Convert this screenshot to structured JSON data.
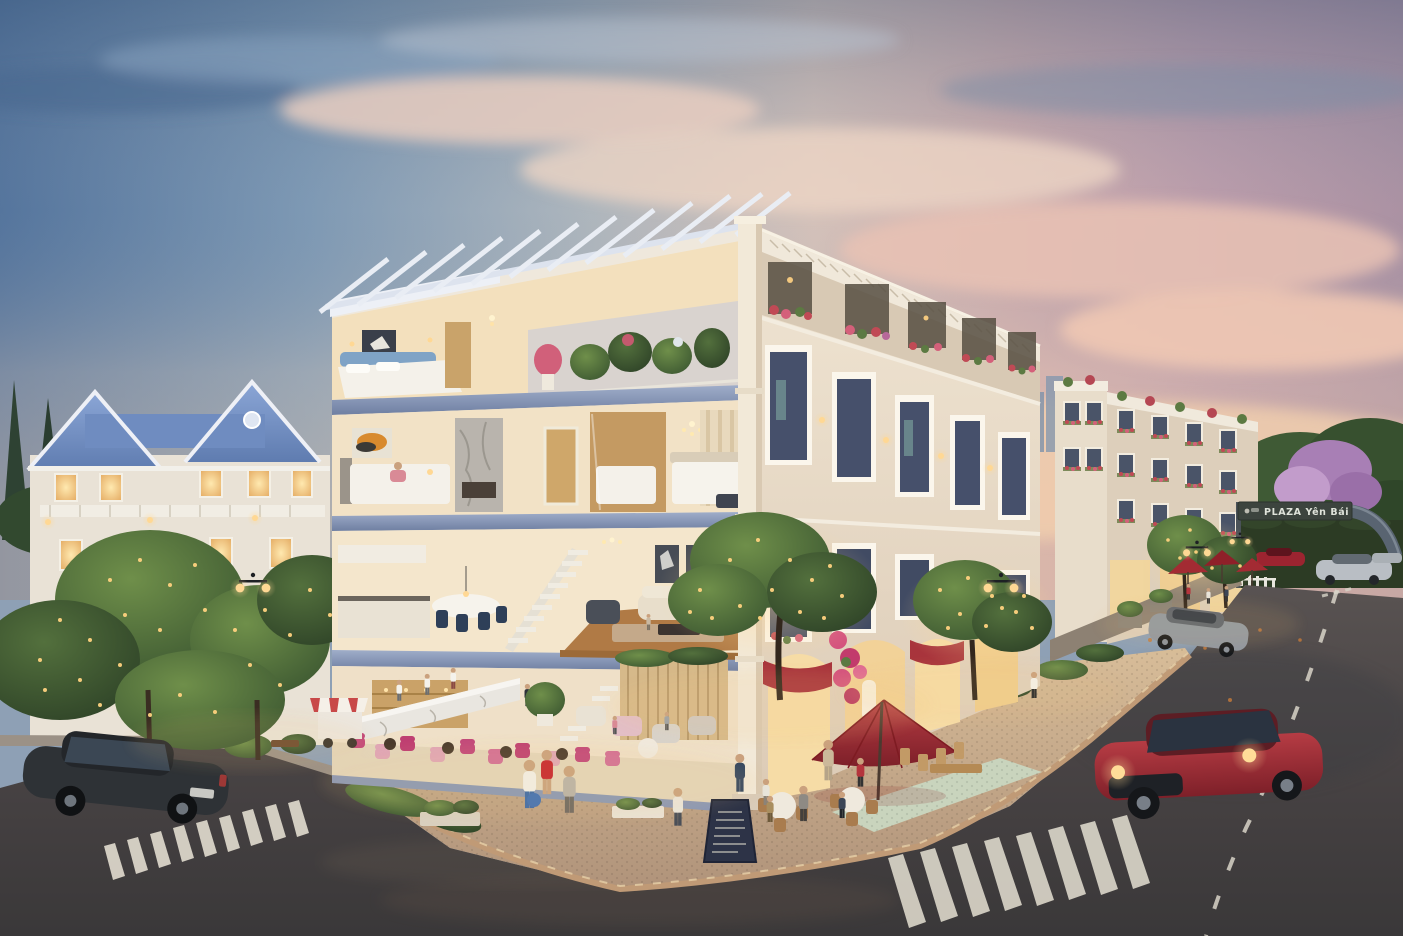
{
  "scene": {
    "title": "Dusk architectural rendering of a neoclassical shophouse corner block with cutaway interiors",
    "time_of_day": "dusk",
    "weather": "clear",
    "description": "Four-storey white shophouse at a street corner shown in section: rooftop pergola terrace, bedrooms, living/kitchen floor and ground-floor cafe; ornate facade with flower balconies, red awnings and string-lit trees; streets with zebra crossings, cars, pedestrians, red patio umbrellas and an entrance gateway arch."
  },
  "signage": {
    "gateway_sign": "PLAZA Yên Bái"
  },
  "objects": {
    "vehicles": [
      "dark sedan bottom-left",
      "red coupe with headlights on",
      "parked silver sedan",
      "silver sedan at gateway",
      "red sports car at gateway",
      "blue car at gateway"
    ],
    "street_furniture": [
      "twin-globe street lamps",
      "red patio umbrellas",
      "menu chalkboard",
      "red striped dessert cart",
      "cafe tables and chairs",
      "white picket fence"
    ]
  },
  "palette": {
    "sky_blue": "#55759d",
    "sky_pink": "#e9c4b2",
    "facade_white": "#ece2d2",
    "slab_blue": "#8b9cc0",
    "roof_blue": "#7f9ccd",
    "interior_warm": "#f5e3c0",
    "umbrella_red": "#a8333a",
    "foliage_green": "#4c6b35",
    "string_light_gold": "#f6c96d",
    "asphalt": "#47464a",
    "plaza_tan": "#c4a98b",
    "car_red": "#9e2f35",
    "car_dark": "#2c2f33"
  }
}
